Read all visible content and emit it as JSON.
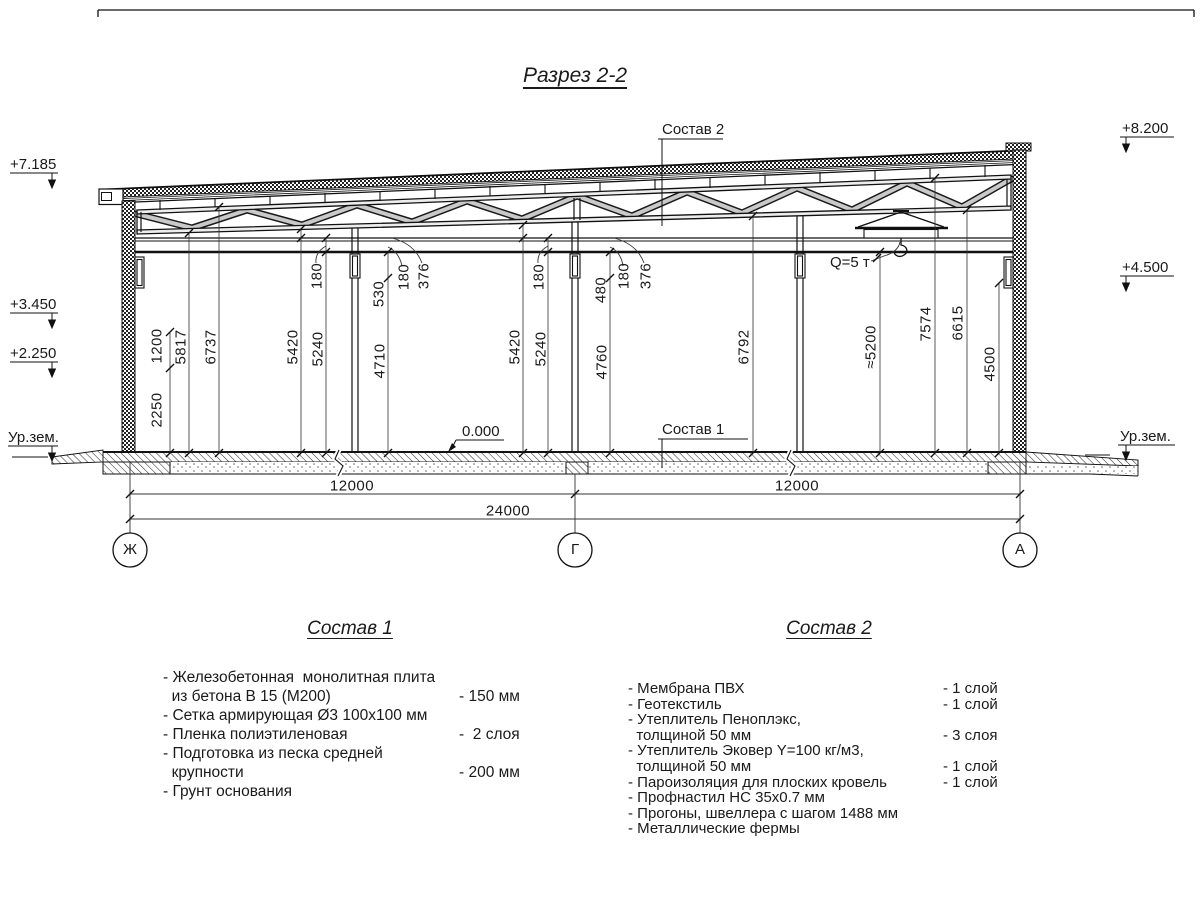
{
  "title": "Разрез 2-2",
  "elevations": {
    "left": [
      {
        "label": "+7.185"
      },
      {
        "label": "+3.450"
      },
      {
        "label": "+2.250"
      },
      {
        "label": "Ур.зем."
      }
    ],
    "right": [
      {
        "label": "+8.200"
      },
      {
        "label": "+4.500"
      },
      {
        "label": "Ур.зем."
      }
    ]
  },
  "vertical_dims": [
    "1200",
    "2250",
    "5817",
    "6737",
    "5420",
    "5240",
    "180",
    "530",
    "4710",
    "180",
    "376",
    "5420",
    "5240",
    "180",
    "480",
    "4760",
    "180",
    "376",
    "6792",
    "≈5200",
    "7574",
    "6615",
    "4500"
  ],
  "horizontal_dims": {
    "left_span": "12000",
    "right_span": "12000",
    "total": "24000"
  },
  "axes": [
    "Ж",
    "Г",
    "А"
  ],
  "callouts": {
    "composition2": "Состав 2",
    "composition1": "Состав 1",
    "zero_level": "0.000",
    "crane_capacity": "Q=5 т"
  },
  "specs": [
    {
      "title": "Состав 1",
      "rows": [
        {
          "text": "- Железобетонная  монолитная плита",
          "value": ""
        },
        {
          "text": "  из бетона В 15 (М200)",
          "value": "- 150 мм"
        },
        {
          "text": "- Сетка армирующая Ø3 100х100 мм",
          "value": ""
        },
        {
          "text": "- Пленка полиэтиленовая",
          "value": "-  2 слоя"
        },
        {
          "text": "- Подготовка из песка средней",
          "value": ""
        },
        {
          "text": "  крупности",
          "value": "- 200 мм"
        },
        {
          "text": "- Грунт основания",
          "value": ""
        }
      ]
    },
    {
      "title": "Состав 2",
      "rows": [
        {
          "text": "- Мембрана ПВХ",
          "value": "- 1 слой"
        },
        {
          "text": "- Геотекстиль",
          "value": "- 1 слой"
        },
        {
          "text": "- Утеплитель Пеноплэкс,",
          "value": ""
        },
        {
          "text": "  толщиной 50 мм",
          "value": "- 3 слоя"
        },
        {
          "text": "- Утеплитель Эковер Y=100 кг/м3,",
          "value": ""
        },
        {
          "text": "  толщиной 50 мм",
          "value": "- 1 слой"
        },
        {
          "text": "- Пароизоляция для плоских кровель",
          "value": "- 1 слой"
        },
        {
          "text": "- Профнастил НС 35х0.7 мм",
          "value": ""
        },
        {
          "text": "- Прогоны, швеллера с шагом 1488 мм",
          "value": ""
        },
        {
          "text": "- Металлические фермы",
          "value": ""
        }
      ]
    }
  ]
}
